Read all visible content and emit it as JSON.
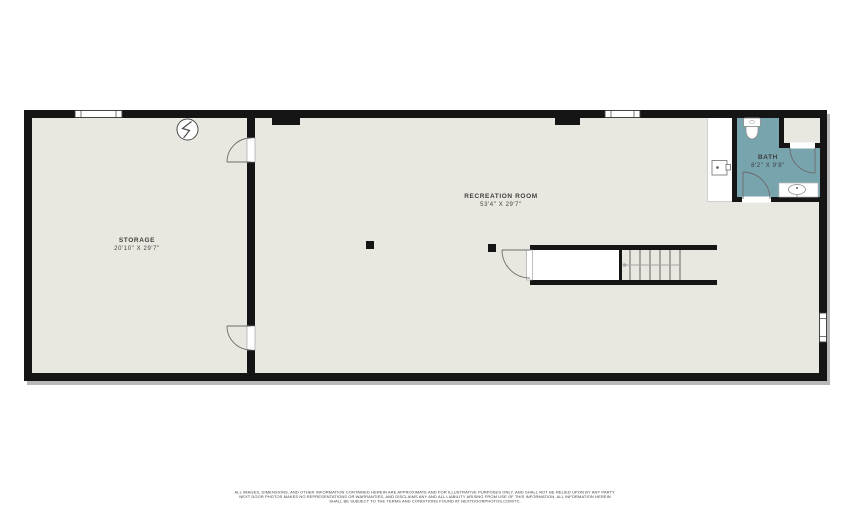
{
  "floorplan": {
    "rooms": [
      {
        "name": "STORAGE",
        "dimensions": "20'10\" X 29'7\""
      },
      {
        "name": "RECREATION ROOM",
        "dimensions": "53'4\" X 29'7\""
      },
      {
        "name": "BATH",
        "dimensions": "8'2\" X 9'8\""
      }
    ],
    "colors": {
      "floor": "#e9e8e0",
      "bath_floor": "#78a4ae",
      "wall": "#151515",
      "landing": "#ffffff",
      "background": "#ffffff"
    },
    "icons": [
      "electrical-panel-icon",
      "toilet-icon",
      "sink-icon",
      "utility-panel-icon",
      "window",
      "door-swing",
      "stairs"
    ]
  },
  "footer": {
    "disclaimer": [
      "ALL IMAGES, DIMENSIONS, AND OTHER INFORMATION CONTAINED HEREIN ARE APPROXIMATE AND FOR ILLUSTRATIVE PURPOSES ONLY, AND SHALL NOT BE RELIED UPON BY ANY PARTY.",
      "NEXT DOOR PHOTOS MAKES NO REPRESENTATIONS OR WARRANTIES, AND DISCLAIMS ANY AND ALL LIABILITY ARISING FROM USE OF THIS INFORMATION. ALL INFORMATION HEREIN",
      "SHALL BE SUBJECT TO THE TERMS AND CONDITIONS FOUND AT NEXTDOORPHOTOS.COM/TC."
    ]
  }
}
